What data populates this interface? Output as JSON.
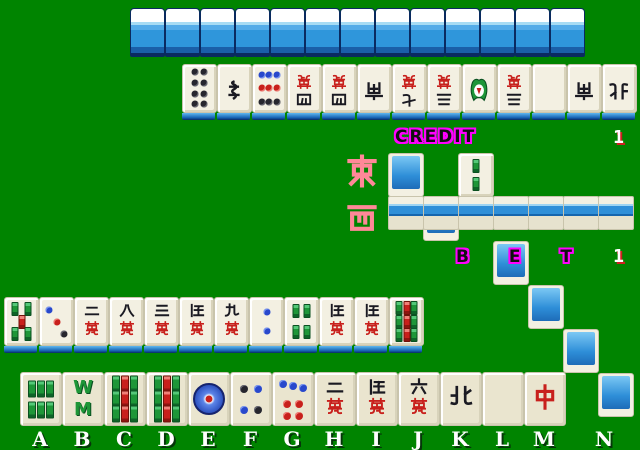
{
  "hud": {
    "credit_label": "CREDIT",
    "credit_value": "1",
    "bet_label": "B E T",
    "bet_value": "1"
  },
  "wind_markers": {
    "round_wind": "東",
    "seat_wind": "西",
    "color": "#FF8898"
  },
  "opponent": {
    "facedown_wall_count": 13,
    "revealed_row": [
      "pin-8",
      "sou-1",
      "pin-9",
      "man-4",
      "man-4",
      "wind-south",
      "man-7",
      "man-3",
      "dragon-hatsu",
      "man-3",
      "blank",
      "wind-south",
      "wind-north"
    ]
  },
  "dead_wall": {
    "top_row": [
      "back",
      "back",
      "face:sou-2",
      "back",
      "back",
      "back",
      "back"
    ],
    "bottom_row_count": 7,
    "dora_indicator": "sou-2"
  },
  "player": {
    "discards": [
      "sou-5",
      "pin-3",
      "man-2",
      "man-8",
      "man-3",
      "man-5",
      "man-9",
      "pin-2",
      "sou-4",
      "man-5",
      "man-5",
      "sou-9"
    ],
    "hand": [
      "sou-6",
      "sou-8",
      "sou-9",
      "sou-9",
      "pin-1",
      "pin-4",
      "pin-7",
      "man-2",
      "man-5",
      "man-6",
      "wind-north",
      "blank",
      "dragon-chun"
    ],
    "slot_letters": [
      "A",
      "B",
      "C",
      "D",
      "E",
      "F",
      "G",
      "H",
      "I",
      "J",
      "K",
      "L",
      "M",
      "N"
    ],
    "empty_slot": "N"
  },
  "colors": {
    "background": "#008400",
    "tile_back_blue": "#2F96DB",
    "tile_face": "#F3F0E2",
    "hand_tile_face": "#EAE5CF",
    "hud_outline_magenta": "#FF00FF",
    "wind_pink": "#FF8898",
    "man_red": "#C8201C",
    "bamboo_green": "#1E9638",
    "circle_blue": "#2848CC",
    "value_shadow_red": "#D02020"
  }
}
